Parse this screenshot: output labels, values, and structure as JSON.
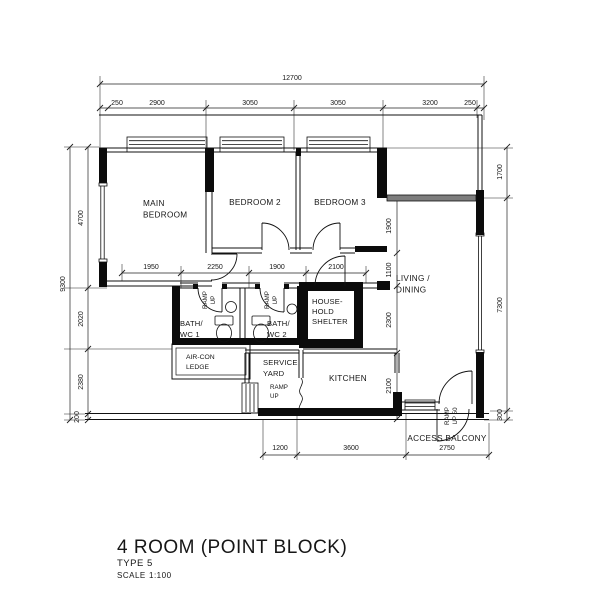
{
  "title_block": {
    "title": "4 ROOM (POINT BLOCK)",
    "type": "TYPE 5",
    "scale_label": "SCALE",
    "scale_value": "1:100"
  },
  "rooms": {
    "main_bedroom": [
      "MAIN",
      "BEDROOM"
    ],
    "bedroom_2": "BEDROOM 2",
    "bedroom_3": "BEDROOM 3",
    "living_dining": [
      "LIVING /",
      "DINING"
    ],
    "kitchen": "KITCHEN",
    "service_yard": [
      "SERVICE",
      "YARD"
    ],
    "household_shelter": [
      "HOUSE-",
      "HOLD",
      "SHELTER"
    ],
    "bath_wc_1": [
      "BATH/",
      "WC 1"
    ],
    "bath_wc_2": [
      "BATH/",
      "WC 2"
    ],
    "aircon_ledge": [
      "AIR-CON",
      "LEDGE"
    ],
    "access_balcony": "ACCESS BALCONY"
  },
  "annotations": {
    "ramp_up": [
      "RAMP",
      "UP"
    ],
    "ramp_up_entrance": [
      "RAMP",
      "UP 50"
    ]
  },
  "dimensions": {
    "top_overall": "12700",
    "top": [
      "250",
      "2900",
      "3050",
      "3050",
      "3200",
      "250"
    ],
    "left_overall": "9300",
    "left": [
      "4700",
      "2020",
      "2380",
      "200"
    ],
    "right": [
      "1700",
      "7300",
      "300"
    ],
    "inner_horizontal": [
      "1950",
      "2250",
      "1900",
      "2100"
    ],
    "inner_vertical": [
      "1900",
      "1100",
      "2300",
      "2100"
    ],
    "bottom": [
      "1200",
      "3600",
      "2750"
    ]
  }
}
